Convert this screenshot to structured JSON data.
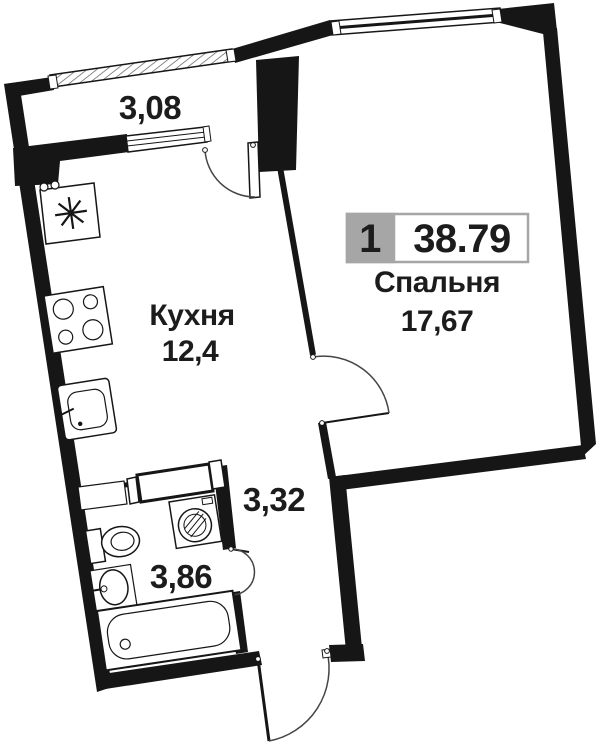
{
  "badge": {
    "room_count": "1",
    "total_area": "38.79"
  },
  "rooms": {
    "balcony": {
      "area": "3,08"
    },
    "kitchen": {
      "name": "Кухня",
      "area": "12,4"
    },
    "bedroom": {
      "name": "Спальня",
      "area": "17,67"
    },
    "hallway": {
      "area": "3,32"
    },
    "bathroom": {
      "area": "3,86"
    }
  },
  "colors": {
    "walls": "#161616",
    "text": "#1c1c1c",
    "badge_gray": "#a6a6a6",
    "background": "#ffffff"
  }
}
